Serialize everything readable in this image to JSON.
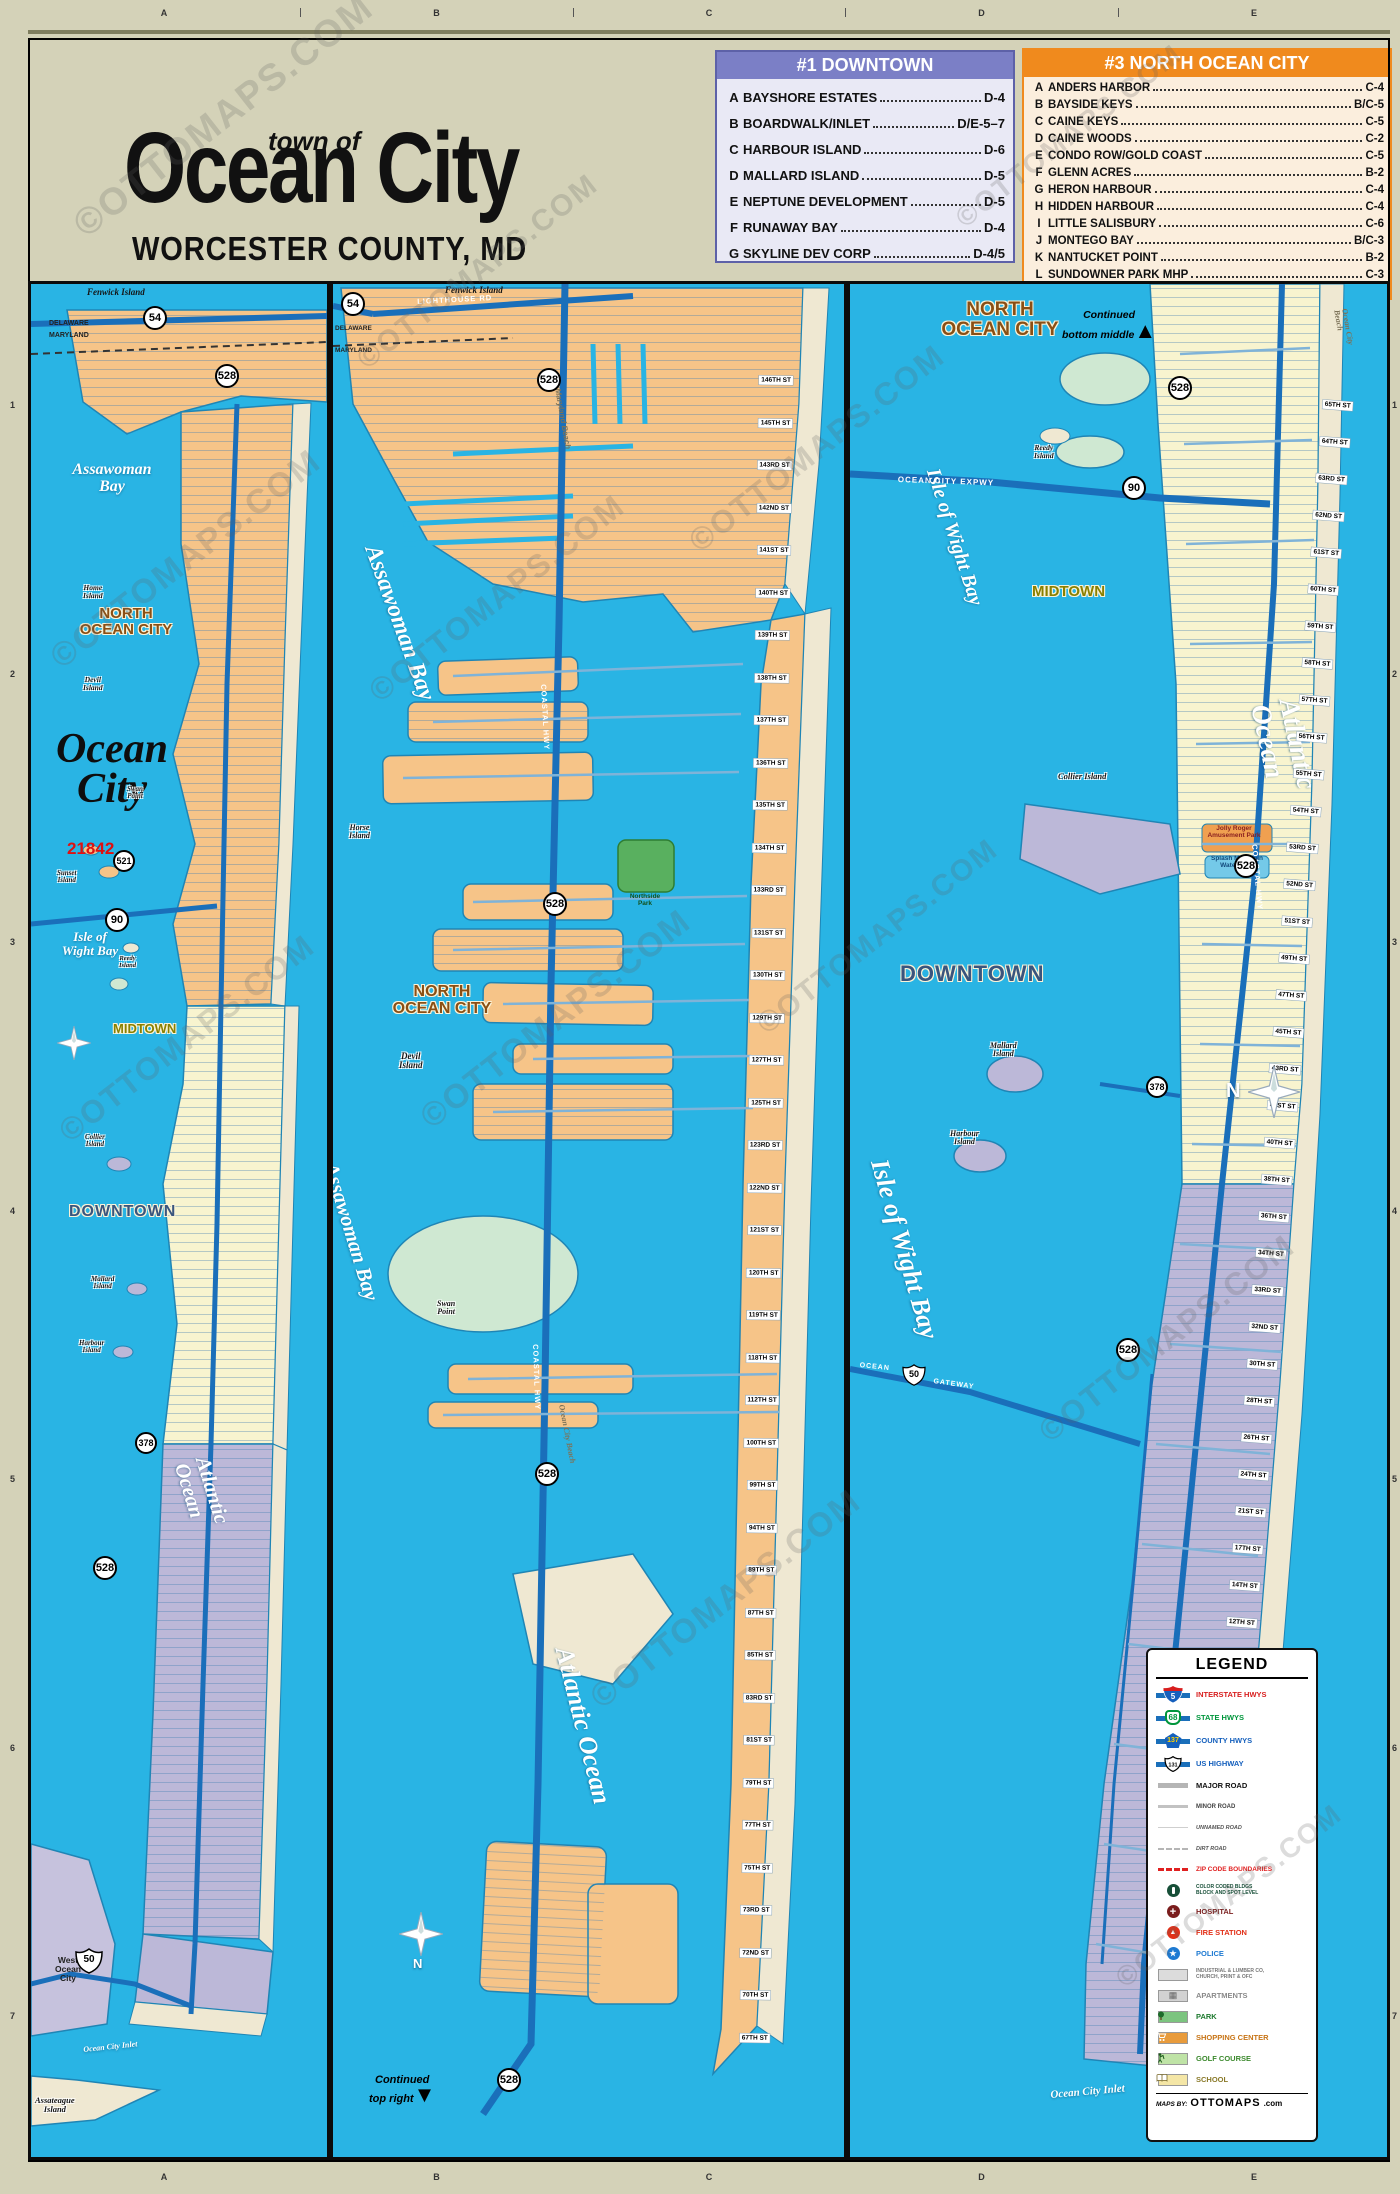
{
  "title": {
    "prefix": "town of",
    "name": "Ocean City",
    "subtitle": "WORCESTER COUNTY, MD"
  },
  "watermark": "©OTTOMAPS.COM",
  "grid": {
    "cols": [
      "A",
      "B",
      "C",
      "D",
      "E"
    ],
    "rows": [
      "1",
      "2",
      "3",
      "4",
      "5",
      "6",
      "7"
    ]
  },
  "tables": {
    "downtown": {
      "title": "#1 DOWNTOWN",
      "items": [
        {
          "key": "A",
          "name": "BAYSHORE ESTATES",
          "ref": "D-4"
        },
        {
          "key": "B",
          "name": "BOARDWALK/INLET",
          "ref": "D/E-5–7"
        },
        {
          "key": "C",
          "name": "HARBOUR ISLAND",
          "ref": "D-6"
        },
        {
          "key": "D",
          "name": "MALLARD ISLAND",
          "ref": "D-5"
        },
        {
          "key": "E",
          "name": "NEPTUNE DEVELOPMENT",
          "ref": "D-5"
        },
        {
          "key": "F",
          "name": "RUNAWAY BAY",
          "ref": "D-4"
        },
        {
          "key": "G",
          "name": "SKYLINE DEV CORP",
          "ref": "D-4/5"
        }
      ]
    },
    "midtown": {
      "title": "#2 MIDTOWN",
      "items": [
        {
          "key": "A",
          "name": "WARRENS PARK MHP",
          "ref": "E-3"
        }
      ]
    },
    "north": {
      "title": "#3 NORTH OCEAN CITY",
      "items": [
        {
          "key": "A",
          "name": "ANDERS HARBOR",
          "ref": "C-4"
        },
        {
          "key": "B",
          "name": "BAYSIDE KEYS",
          "ref": "B/C-5"
        },
        {
          "key": "C",
          "name": "CAINE KEYS",
          "ref": "C-5"
        },
        {
          "key": "D",
          "name": "CAINE WOODS",
          "ref": "C-2"
        },
        {
          "key": "E",
          "name": "CONDO ROW/GOLD COAST",
          "ref": "C-5"
        },
        {
          "key": "F",
          "name": "GLENN ACRES",
          "ref": "B-2"
        },
        {
          "key": "G",
          "name": "HERON HARBOUR",
          "ref": "C-4"
        },
        {
          "key": "H",
          "name": "HIDDEN HARBOUR",
          "ref": "C-4"
        },
        {
          "key": "I",
          "name": "LITTLE SALISBURY",
          "ref": "C-6"
        },
        {
          "key": "J",
          "name": "MONTEGO BAY",
          "ref": "B/C-3"
        },
        {
          "key": "K",
          "name": "NANTUCKET POINT",
          "ref": "B-2"
        },
        {
          "key": "L",
          "name": "SUNDOWNER PARK MHP",
          "ref": "C-3"
        },
        {
          "key": "M",
          "name": "SUNSET ISLAND",
          "ref": "C-7"
        }
      ]
    }
  },
  "shields": {
    "s54": "54",
    "s528": "528",
    "s521": "521",
    "s90": "90",
    "s378": "378",
    "s50": "50"
  },
  "icons": {
    "up_arrow": "▲",
    "down_arrow": "▼",
    "north": "N",
    "police_star": "★",
    "fire_flame": "▲",
    "hospital_cross": "+",
    "apartments_glyph": "▦"
  },
  "panels": {
    "left": {
      "fenwick": "Fenwick Island",
      "delaware": "DELAWARE",
      "maryland": "MARYLAND",
      "assawoman": "Assawoman\nBay",
      "home_island": "Home\nIsland",
      "north_ocean_city": "NORTH\nOCEAN CITY",
      "devil_island": "Devil\nIsland",
      "ocean_city_big": "Ocean\nCity",
      "zip": "21842",
      "swan_point": "Swan\nPoint",
      "sunset_island": "Sunset\nIsland",
      "isle_of_wight": "Isle of\nWight Bay",
      "reedy_island": "Reedy\nIsland",
      "midtown": "MIDTOWN",
      "collier_island": "Collier\nIsland",
      "downtown": "DOWNTOWN",
      "mallard_island": "Mallard\nIsland",
      "harbour_island": "Harbour\nIsland",
      "atlantic": "Atlantic Ocean",
      "west_ocean_city": "West\nOcean\nCity",
      "inlet": "Ocean City Inlet",
      "assateague": "Assateague\nIsland"
    },
    "middle": {
      "fenwick": "Fenwick Island",
      "lighthouse_rd": "LIGHTHOUSE RD",
      "delaware": "DELAWARE",
      "maryland": "MARYLAND",
      "assawoman": "Assawoman Bay",
      "assawoman2": "Assawoman Bay",
      "north_ocean_city": "NORTH\nOCEAN CITY",
      "devil_island": "Devil\nIsland",
      "horse_island": "Horse\nIsland",
      "swan_point": "Swan\nPoint",
      "northside_park": "Northside\nPark",
      "coastal_hwy": "COASTAL HWY",
      "maryland_beach": "Maryland Beach",
      "atlantic": "Atlantic Ocean",
      "ocean_city_beach": "Ocean City Beach",
      "continued": "Continued\ntop right",
      "streets": [
        "146TH ST",
        "145TH ST",
        "143RD ST",
        "142ND ST",
        "141ST ST",
        "140TH ST",
        "139TH ST",
        "138TH ST",
        "137TH ST",
        "136TH ST",
        "135TH ST",
        "134TH ST",
        "133RD ST",
        "131ST ST",
        "130TH ST",
        "129TH ST",
        "127TH ST",
        "125TH ST",
        "123RD ST",
        "122ND ST",
        "121ST ST",
        "120TH ST",
        "119TH ST",
        "118TH ST",
        "112TH ST",
        "100TH ST",
        "99TH ST",
        "94TH ST",
        "89TH ST",
        "87TH ST",
        "85TH ST",
        "83RD ST",
        "81ST ST",
        "79TH ST",
        "77TH ST",
        "75TH ST",
        "73RD ST",
        "72ND ST",
        "70TH ST",
        "67TH ST"
      ]
    },
    "right": {
      "north_ocean_city": "NORTH\nOCEAN CITY",
      "continued": "Continued\nbottom middle",
      "oc_expwy": "OCEAN CITY EXPWY",
      "ocean_city_beach": "Ocean City Beach",
      "reedy_island": "Reedy\nIsland",
      "isle_of_wight": "Isle of Wight Bay",
      "isle_of_wight2": "Isle of Wight Bay",
      "midtown": "MIDTOWN",
      "coastal_hwy": "COASTAL HWY",
      "collier_island": "Collier Island",
      "jolly_roger": "Jolly Roger\nAmusement Park",
      "splash_mtn": "Splash Mountain\nWater Park",
      "downtown": "DOWNTOWN",
      "mallard_island": "Mallard\nIsland",
      "harbour_island": "Harbour\nIsland",
      "atlantic": "Atlantic Ocean",
      "ocean_gateway_a": "OCEAN",
      "ocean_gateway_b": "GATEWAY",
      "fishing_pier": "Ocean City\nFishing Pier",
      "inlet": "Ocean City Inlet",
      "streets": [
        "65TH ST",
        "64TH ST",
        "63RD ST",
        "62ND ST",
        "61ST ST",
        "60TH ST",
        "59TH ST",
        "58TH ST",
        "57TH ST",
        "56TH ST",
        "55TH ST",
        "54TH ST",
        "53RD ST",
        "52ND ST",
        "51ST ST",
        "49TH ST",
        "47TH ST",
        "45TH ST",
        "43RD ST",
        "41ST ST",
        "40TH ST",
        "38TH ST",
        "36TH ST",
        "34TH ST",
        "33RD ST",
        "32ND ST",
        "30TH ST",
        "28TH ST",
        "26TH ST",
        "24TH ST",
        "21ST ST",
        "17TH ST",
        "14TH ST",
        "12TH ST",
        "9TH ST",
        "7TH ST",
        "4TH ST",
        "1ST ST",
        "N DIVISION ST",
        "DORCHESTER ST",
        "SOMERSET ST",
        "WICOMICO ST",
        "S DIVISION ST"
      ]
    }
  },
  "legend": {
    "title": "LEGEND",
    "interstate": {
      "num": "5",
      "label": "INTERSTATE HWYS"
    },
    "state": {
      "num": "68",
      "label": "STATE HWYS"
    },
    "county": {
      "num": "137",
      "label": "COUNTY HWYS"
    },
    "us": {
      "num": "131",
      "label": "US HIGHWAY"
    },
    "major_road": "MAJOR ROAD",
    "minor_road": "MINOR ROAD",
    "unnamed_road": "UNNAMED ROAD",
    "dirt_road": "DIRT ROAD",
    "zip_boundaries": "ZIP CODE BOUNDARIES",
    "subdiv_line1": "COLOR CODED BLDGS",
    "subdiv_line2": "BLOCK AND SPOT LEVEL",
    "hospital": "HOSPITAL",
    "fire": "FIRE STATION",
    "police": "POLICE",
    "industrial_line1": "INDUSTRIAL & LUMBER CO,",
    "industrial_line2": "CHURCH, PRINT & OFC",
    "apartments": "APARTMENTS",
    "park": "PARK",
    "shopping": "SHOPPING CENTER",
    "golf": "GOLF COURSE",
    "school": "SCHOOL",
    "credit_prefix": "MAPS BY:",
    "credit_brand": "OTTOMAPS",
    "credit_suffix": ".com"
  }
}
